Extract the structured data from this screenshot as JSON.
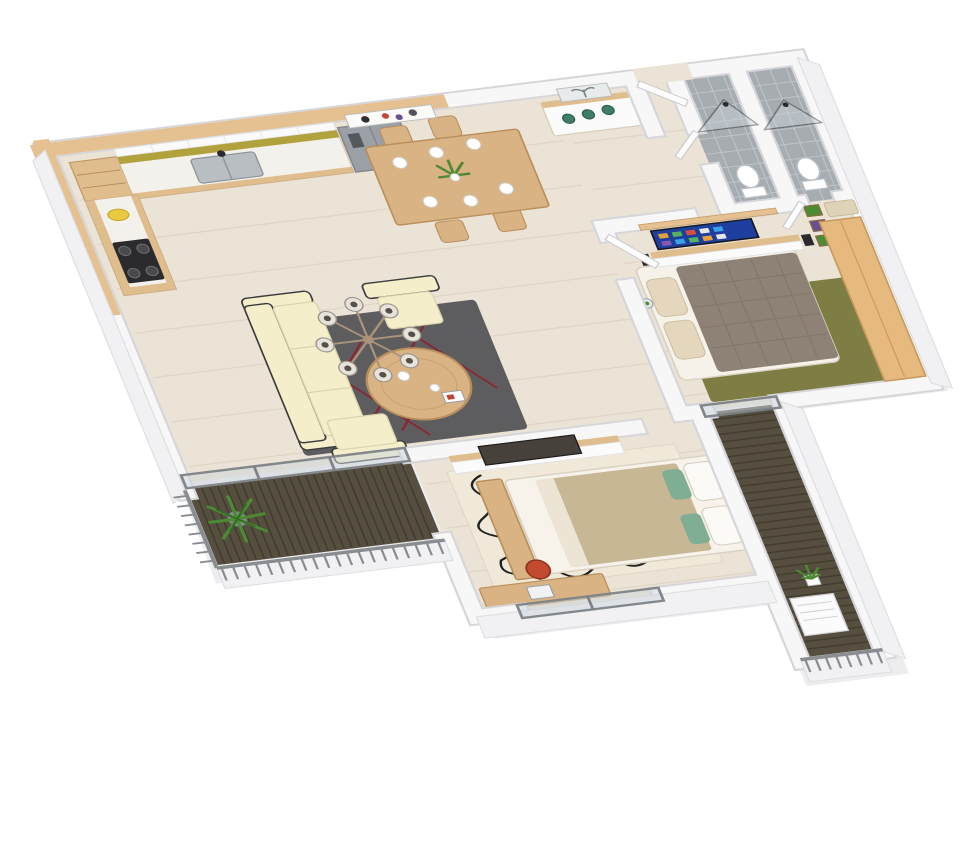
{
  "meta": {
    "title": "3D apartment floor plan render",
    "view": "isometric cutaway viewed from above",
    "background_style": "plain white"
  },
  "palette": {
    "background": "#ffffff",
    "shadow": "#ededf0",
    "wallFill": "#f7f7f8",
    "wallEdge": "#d6d6da",
    "wallFace": "#f1f1f4",
    "woodCap": "#e5c191",
    "floorWood": "#ebe3d5",
    "floorLine": "#dcd1bf",
    "tileFloor": "#a6acb0",
    "tileLine": "#c2c7cb",
    "counterWood": "#e0bd8c",
    "marble": "#f3f1eb",
    "backsplash": "#b1a23e",
    "cabinetWhite": "#fafafb",
    "fridgeGray": "#9aa0a6",
    "applianceDark": "#2b2b2e",
    "tableWood": "#d9b383",
    "sofaCream": "#f4eeca",
    "sofaFrame": "#3c3c3f",
    "rugGray": "#5d5d60",
    "rugRed": "#8e2231",
    "rugOlive": "#7d7d44",
    "rugCream": "#f0e9da",
    "scribble": "#20201e",
    "bedTaupe": "#8e8175",
    "quiltLine": "#7a6e62",
    "bedTan": "#c8b795",
    "pillowBeige": "#e5d7bd",
    "pillowGreen": "#80ae93",
    "headboardGray": "#6b7074",
    "consoleWhite": "#fbfbfc",
    "wardrobeWood": "#e6b97e",
    "tvBlue": "#1e3f9e",
    "tvDark": "#46413a",
    "deckDark": "#564f3f",
    "deckLine": "#3e382b",
    "railGray": "#898d91",
    "glass": "#ccd5da",
    "frameGray": "#7e8388",
    "plantGreen": "#4c8a33",
    "plantDark": "#2f6b22",
    "accentTeal": "#3f7d6a",
    "doorWhite": "#fdfdfe",
    "artRed": "#c2453a",
    "artPurple": "#6a4f8f",
    "chandelierGlass": "#e7e3db",
    "chandelierMetal": "#ab9379"
  },
  "apartment": {
    "rooms": [
      {
        "id": "kitchen",
        "label": "Kitchen",
        "furniture": [
          "L-shaped wood counter",
          "double sink with black faucet",
          "gas stove",
          "side-by-side fridge",
          "white upper cabinets",
          "yellow backsplash",
          "open corner shelves",
          "wood wall cap band"
        ]
      },
      {
        "id": "dining",
        "label": "Dining Area",
        "furniture": [
          "wood dining table",
          "4 wood chairs",
          "white place settings",
          "green plant centerpiece",
          "abstract wall art",
          "white sideboard with wood top",
          "3 green bowls",
          "tree artwork"
        ]
      },
      {
        "id": "living",
        "label": "Living Room",
        "furniture": [
          "cream 3-seat sofa with dark frame",
          "2 cream armchairs",
          "round wood coffee table",
          "dark grey rug with red line pattern",
          "8-globe sputnik chandelier"
        ]
      },
      {
        "id": "entry",
        "label": "Entry Vestibule",
        "furniture": [
          "white entry door ajar"
        ]
      },
      {
        "id": "bath1",
        "label": "Bathroom 1",
        "furniture": [
          "corner glass shower",
          "toilet",
          "grey tile floor",
          "white subway-tile walls"
        ]
      },
      {
        "id": "bath2",
        "label": "Bathroom 2",
        "furniture": [
          "corner glass shower",
          "toilet",
          "grey tile floor",
          "white subway-tile walls"
        ]
      },
      {
        "id": "master",
        "label": "Master Bedroom",
        "furniture": [
          "double bed with taupe quilt",
          "beige pillows",
          "olive green rug",
          "wall TV with blue smart-tv screen",
          "wood shelf",
          "floating media console",
          "2 speakers",
          "3 framed prints",
          "light wood wardrobe",
          "beige bath mat",
          "hanging glass planter"
        ]
      },
      {
        "id": "bedroom2",
        "label": "Second Bedroom",
        "furniture": [
          "double bed with tan blanket",
          "grey headboard",
          "green accent pillows",
          "wood blanket chest at foot",
          "cream rug with black scribble pattern",
          "TV on partition console",
          "desk with laptop",
          "red chair",
          "south window"
        ]
      },
      {
        "id": "balcony1",
        "label": "Living Room Balcony",
        "furniture": [
          "dark wood slat deck",
          "fern in grey pot",
          "metal bar railing",
          "grey-framed sliding glass door"
        ]
      },
      {
        "id": "balcony2",
        "label": "Bedroom Balcony",
        "furniture": [
          "dark wood slat deck",
          "potted plant",
          "white AC unit",
          "metal bar railing",
          "grey-framed glass door"
        ]
      }
    ],
    "counts": {
      "bathrooms": 2,
      "balconies": 2,
      "dining_chairs": 4,
      "chandelier_globes": 8,
      "framed_prints_master_wall": 3,
      "sofa_seats": 3,
      "armchairs": 2
    }
  }
}
